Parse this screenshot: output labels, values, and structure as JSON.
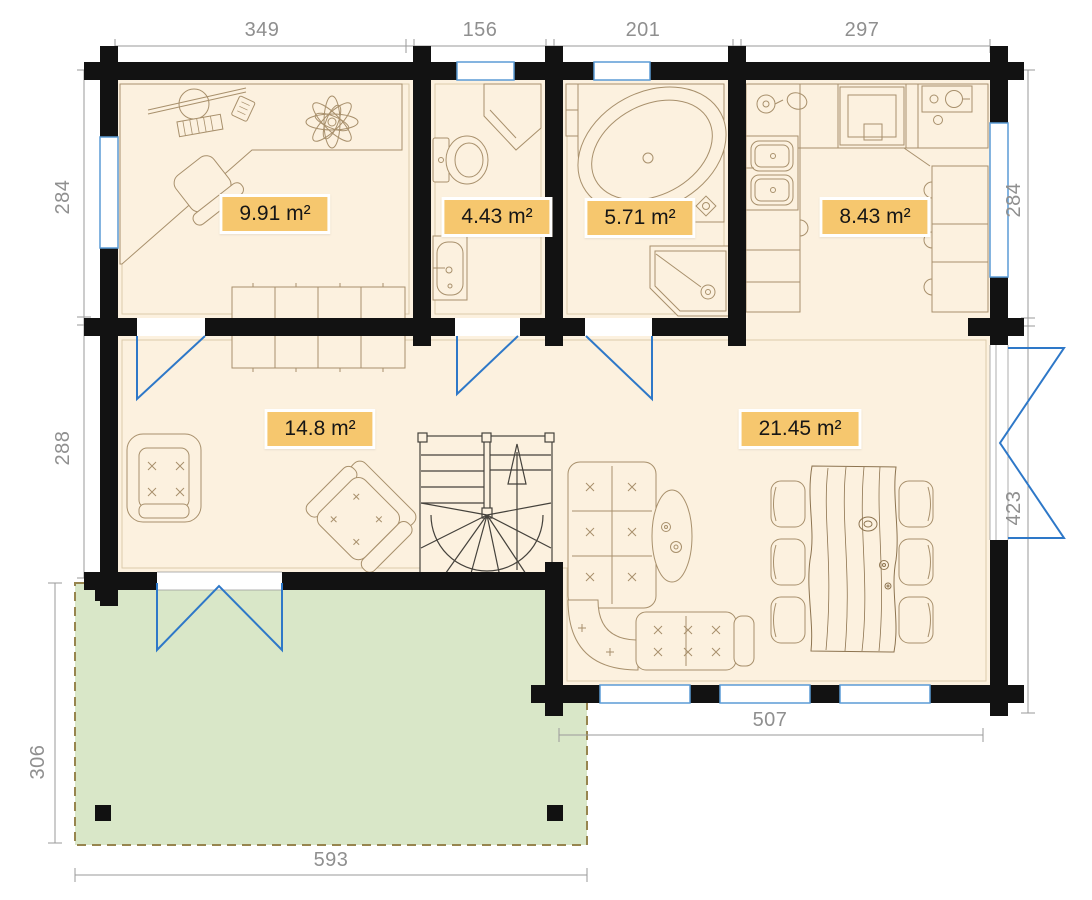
{
  "title": "Cabin ground floor plan with terrace",
  "dimensions": {
    "top": [
      "349",
      "156",
      "201",
      "297"
    ],
    "left_upper": "284",
    "left_lower": "288",
    "left_terrace": "306",
    "right_upper": "284",
    "right_lower": "423",
    "bottom_building": "507",
    "bottom_terrace": "593"
  },
  "rooms": {
    "office": {
      "area": "9.91 m²"
    },
    "wc": {
      "area": "4.43 m²"
    },
    "bathroom": {
      "area": "5.71 m²"
    },
    "kitchen": {
      "area": "8.43 m²"
    },
    "hall": {
      "area": "14.8 m²"
    },
    "living_room": {
      "area": "21.45 m²"
    }
  },
  "colors": {
    "floor": "#fcf1df",
    "wall": "#121212",
    "terrace_fill": "#d9e7c8",
    "terrace_border": "#97854f",
    "window_frame": "#5b9bd5",
    "door_swing": "#2e78c8",
    "badge_background": "#f6c76e",
    "dimension_text": "#8f8f8f",
    "furniture_line": "#a8906c",
    "stairs_line": "#45423c"
  }
}
